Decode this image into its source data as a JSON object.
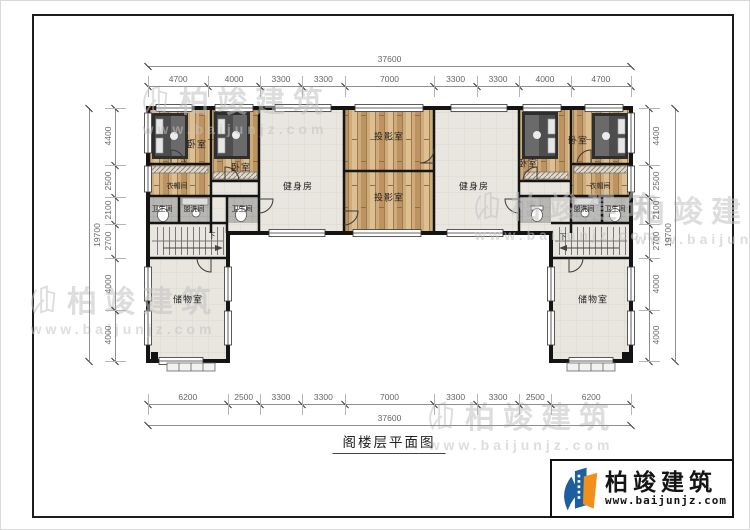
{
  "title": "阁楼层平面图",
  "brand": {
    "name": "柏竣建筑",
    "url": "www.baijunjz.com"
  },
  "watermark": {
    "name": "柏竣建筑",
    "url": "www.baijunjz.com"
  },
  "stairs": {
    "down_label": "下"
  },
  "rooms": {
    "bedroom": "卧室",
    "closet": "衣帽间",
    "bath": "卫生间",
    "wash": "盥洗间",
    "gym": "健身房",
    "projection": "投影室",
    "storage": "储物室"
  },
  "dimensions": {
    "top": {
      "total": "37600",
      "segments": [
        4700,
        4000,
        3300,
        3300,
        7000,
        3300,
        3300,
        4000,
        4700
      ]
    },
    "bottom": {
      "total": "37600",
      "segments": [
        6200,
        2500,
        3300,
        3300,
        7000,
        3300,
        3300,
        2500,
        6200
      ]
    },
    "left": {
      "total": "19700",
      "segments": [
        4400,
        2500,
        2100,
        2700,
        4000,
        4000
      ]
    },
    "right": {
      "total": "19700",
      "segments": [
        4400,
        2500,
        2100,
        2700,
        4000,
        4000
      ]
    }
  }
}
